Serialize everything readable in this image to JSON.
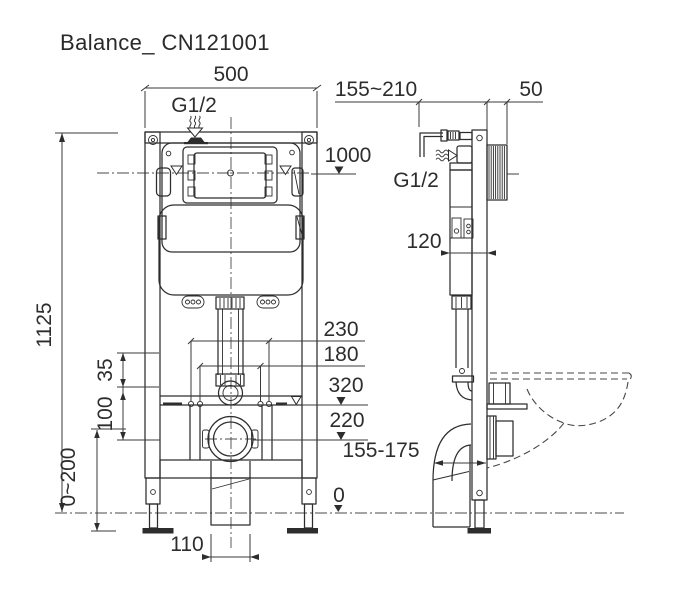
{
  "title": "Balance_ CN121001",
  "colors": {
    "line": "#2d2d2d",
    "dimension": "#3a3a3a",
    "background": "#ffffff"
  },
  "front_view": {
    "dims": {
      "width": "500",
      "inlet_thread": "G1/2",
      "panel_level": "1000",
      "total_height": "1125",
      "bolt_span_outer": "230",
      "bolt_span_inner": "180",
      "flush_level": "320",
      "outlet_level": "220",
      "bracket_gap": "35",
      "bracket_height": "100",
      "leg_range": "0~200",
      "duct_width": "110",
      "floor": "0"
    }
  },
  "side_view": {
    "dims": {
      "depth_range": "155~210",
      "plate_depth": "50",
      "inlet_thread": "G1/2",
      "tank_depth": "120",
      "outlet_range": "155-175"
    }
  }
}
